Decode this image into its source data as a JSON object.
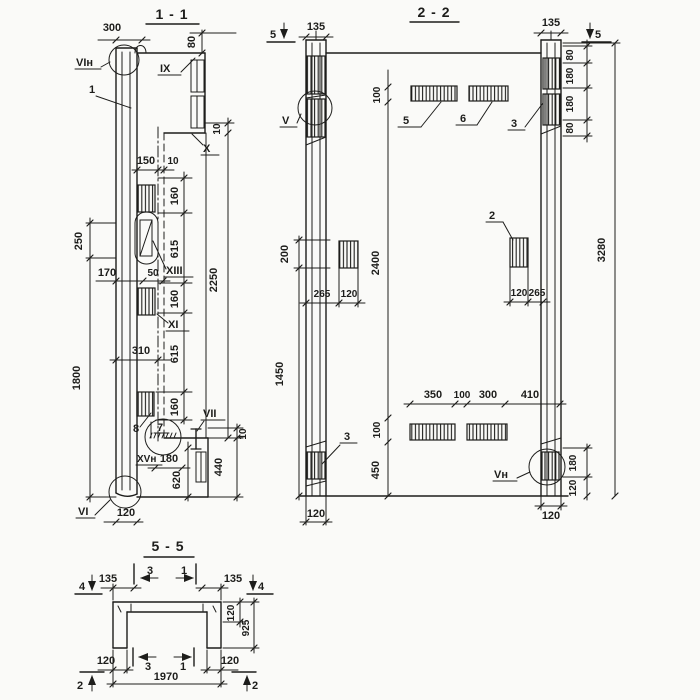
{
  "colors": {
    "ink": "#1d1d1b",
    "paper": "#fafaf8"
  },
  "views": {
    "v11": {
      "title": "1 - 1",
      "labels": {
        "vin": "VIн",
        "n1": "1",
        "ix": "IX",
        "x": "X",
        "xiii": "XIII",
        "xi": "XI",
        "n8": "8",
        "n7": "7",
        "vii": "VII",
        "xvn": "XVн",
        "vi": "VI"
      },
      "dims": {
        "d300": "300",
        "d80": "80",
        "d10t": "10",
        "d150": "150",
        "d10w": "10",
        "d160a": "160",
        "d615a": "615",
        "d160b": "160",
        "d615b": "615",
        "d160c": "160",
        "d250": "250",
        "d1800": "1800",
        "d170": "170",
        "d50": "50",
        "d310": "310",
        "d2250": "2250",
        "d180": "180",
        "d620": "620",
        "d440": "440",
        "d10b": "10",
        "d120": "120"
      }
    },
    "v22": {
      "title": "2 - 2",
      "marks": {
        "s5l": "5",
        "s5r": "5"
      },
      "labels": {
        "v": "V",
        "n3t": "3",
        "n5": "5",
        "n6": "6",
        "n2": "2",
        "n3b": "3",
        "vn": "Vн"
      },
      "dims": {
        "d135l": "135",
        "d135r": "135",
        "d80a": "80",
        "d180a": "180",
        "d180b": "180",
        "d80b": "80",
        "d100t": "100",
        "d2400": "2400",
        "d100b": "100",
        "d450": "450",
        "d200": "200",
        "d1450": "1450",
        "d265l": "265",
        "d120lm": "120",
        "d120rm": "120",
        "d265r": "265",
        "d3280": "3280",
        "d350": "350",
        "d100m": "100",
        "d300": "300",
        "d410": "410",
        "d180br": "180",
        "d120br": "120",
        "d120bl": "120",
        "d120brr": "120"
      }
    },
    "v55": {
      "title": "5 - 5",
      "marks": {
        "s4l": "4",
        "s4r": "4",
        "s2l": "2",
        "s2r": "2",
        "c3t": "3",
        "c1t": "1",
        "c3b": "3",
        "c1b": "1"
      },
      "dims": {
        "d135l": "135",
        "d135r": "135",
        "d120f": "120",
        "d925": "925",
        "d120bl": "120",
        "d120br": "120",
        "d1970": "1970"
      }
    }
  }
}
